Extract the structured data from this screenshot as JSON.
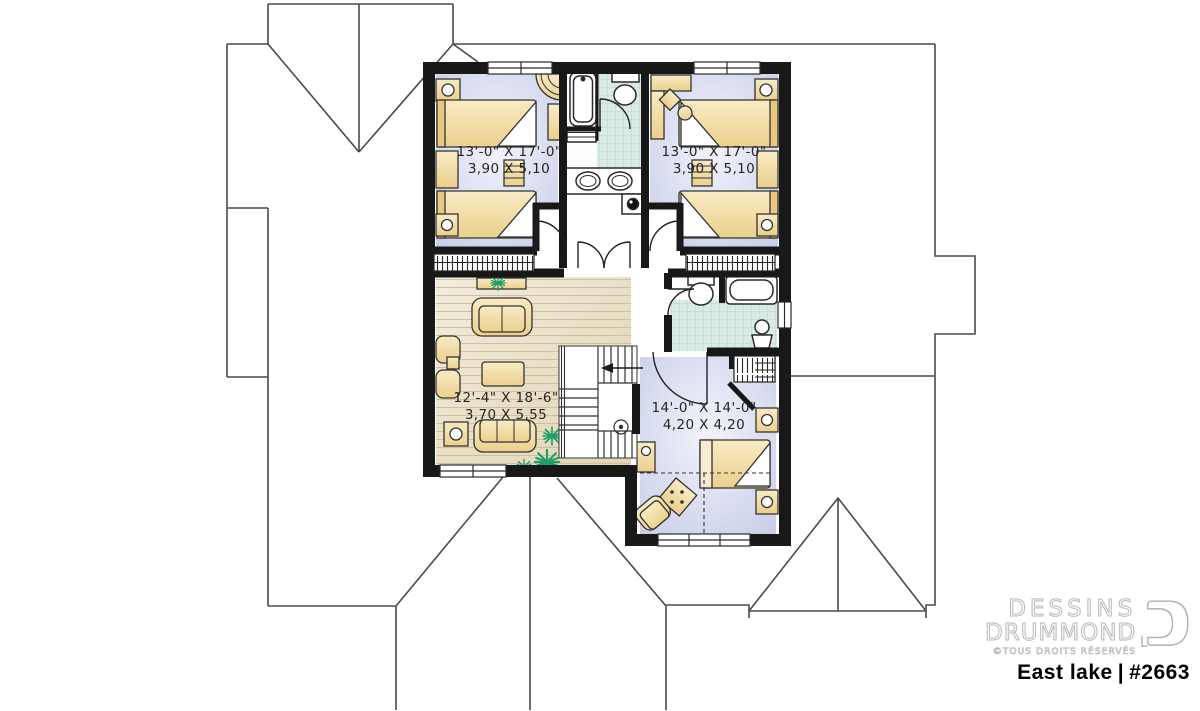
{
  "branding": {
    "line1": "DESSINS",
    "line2": "DRUMMOND",
    "rights": "©TOUS DROITS RÉSERVÉS",
    "plan_name": "East lake",
    "separator": "|",
    "plan_number": "#2663"
  },
  "plan": {
    "rooms": [
      {
        "name": "bedroom-top-left",
        "size_imperial": "13'-0\" X 17'-0\"",
        "size_metric": "3,90 X 5,10"
      },
      {
        "name": "bedroom-top-right",
        "size_imperial": "13'-0\" X 17'-0\"",
        "size_metric": "3,90 X 5,10"
      },
      {
        "name": "living-area",
        "size_imperial": "12'-4\" X 18'-6\"",
        "size_metric": "3,70 X 5,55"
      },
      {
        "name": "master-bedroom",
        "size_imperial": "14'-0\" X 14'-0\"",
        "size_metric": "4,20 X 4,20"
      }
    ]
  },
  "colors": {
    "wall": "#181818",
    "bedroom_floor": "#c5cae7",
    "tile_floor": "#d9ebe2",
    "wood_floor": "#e9dcc3",
    "furniture": "#f2d9a0",
    "plant": "#1f9e6a",
    "roof_line": "#4a4a4a",
    "plan_title_color": "#000000",
    "watermark_text": "#ffffff"
  }
}
